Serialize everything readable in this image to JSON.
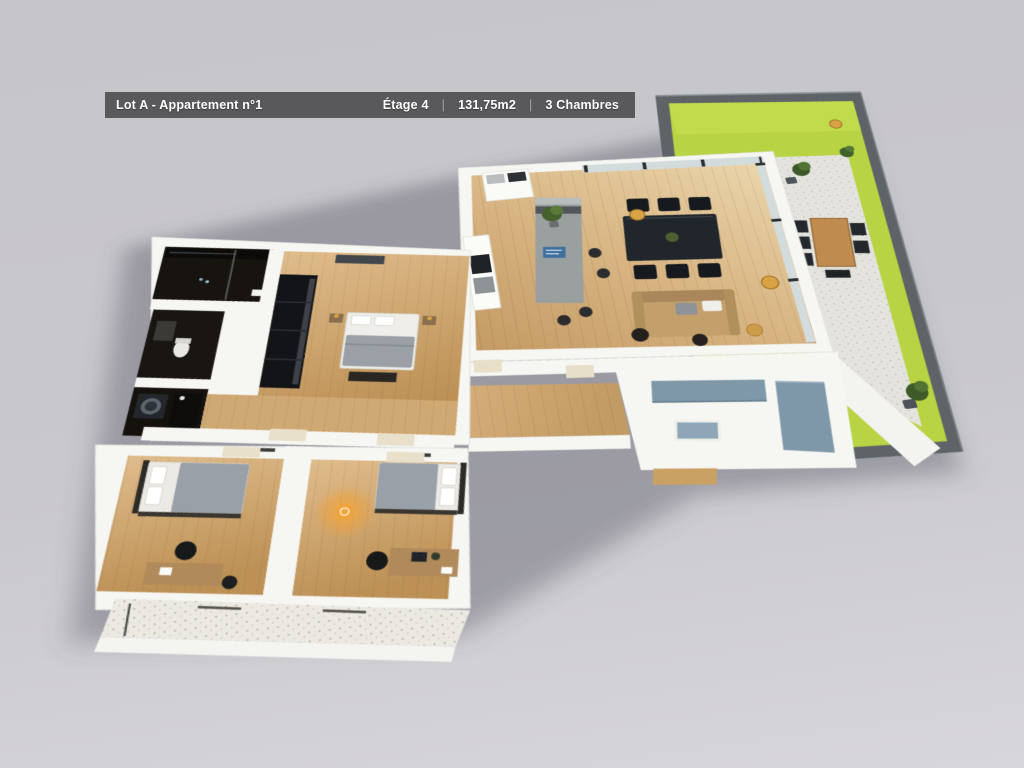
{
  "header": {
    "lot": "Lot A - Appartement n°1",
    "floor": "Étage 4",
    "area": "131,75m2",
    "rooms": "3 Chambres",
    "separator": "|"
  },
  "colors": {
    "background_top": "#c6c5ca",
    "background_bottom": "#d7d6da",
    "header_bg": "#59585b",
    "header_text": "#ffffff",
    "grass": "#b8d343",
    "grass_light": "#c9e155",
    "wall_white": "#f6f6f3",
    "wall_dark": "#5d6366",
    "tile": "#e4e3dd",
    "wood_light": "#ecd9b0",
    "wood_mid": "#cda670",
    "wood_dark": "#b8905a",
    "glass": "#d3dcdd",
    "frame_dark": "#2a2e31",
    "accent_gold": "#d9a243",
    "accent_blue": "#7f98a9",
    "furniture_dark": "#1d2023",
    "sofa_tan": "#c3a06b",
    "island_gray": "#9aa0a0",
    "glow_orange": "#f0a13a",
    "bath_dark": "#17130e"
  }
}
